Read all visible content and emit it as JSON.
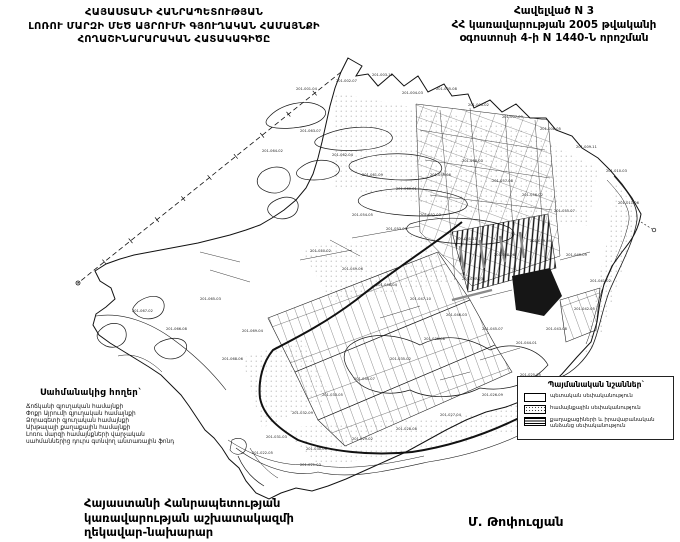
{
  "document": {
    "title_lines": [
      "ՀԱՅԱՍՏԱՆԻ ՀԱՆՐԱՊԵՏՈՒԹՅԱՆ",
      "ԼՈՌՈՒ ՄԱՐԶԻ ՄԵԾ ԱՅՐՈՒՄԻ ԳՅՈՒՂԱԿԱՆ ՀԱՄԱՅՆՔԻ",
      "ՀՈՂԱՇԻՆԱՐԱՐԱԿԱՆ ՀԱՏԱԿԱԳԻԾԸ"
    ],
    "annex_lines": [
      "Հավելված N 3",
      "ՀՀ կառավարության 2005 թվականի",
      "օգոստոսի 4-ի N 1440-Ն որոշման"
    ]
  },
  "adjacent_lands": {
    "title": "Սահմանակից հողեր`",
    "lines": [
      "Ճոճկանի գյուղական համայնքի",
      "Փոքր Այրումի գյուղական համայնքի",
      "Ձորագետի գյուղական համայնքի",
      "Ախթալայի քաղաքային համայնքի",
      "Լոռու մարզի համայնքների վարչական",
      "սահմաններից դուրս գտնվող անտառային ֆոնդ"
    ]
  },
  "legend": {
    "title": "Պայմանական նշաններ`",
    "items": [
      {
        "label": "պետական սեփականություն"
      },
      {
        "label": "համայնքային սեփականություն"
      },
      {
        "label": "քաղաքացիների և իրավաբանական անձանց սեփականություն"
      }
    ]
  },
  "footer": {
    "issuer_lines": [
      "Հայաստանի Հանրապետության",
      "կառավարության աշխատակազմի",
      "ղեկավար-նախարար"
    ],
    "signature": "Մ. Թոփուզյան"
  },
  "map": {
    "parcel_labels": [
      [
        "201-001-04",
        296,
        90
      ],
      [
        "201-002-07",
        336,
        82
      ],
      [
        "201-003-12",
        372,
        76
      ],
      [
        "201-004-03",
        402,
        94
      ],
      [
        "201-005-08",
        436,
        90
      ],
      [
        "201-006-02",
        468,
        106
      ],
      [
        "201-007-09",
        502,
        118
      ],
      [
        "201-008-05",
        540,
        130
      ],
      [
        "201-009-11",
        576,
        148
      ],
      [
        "201-010-03",
        606,
        172
      ],
      [
        "201-011-06",
        618,
        204
      ],
      [
        "201-064-02",
        262,
        152
      ],
      [
        "201-063-07",
        300,
        132
      ],
      [
        "201-062-04",
        332,
        156
      ],
      [
        "201-061-09",
        362,
        176
      ],
      [
        "201-060-01",
        396,
        190
      ],
      [
        "201-059-06",
        430,
        176
      ],
      [
        "201-058-03",
        462,
        162
      ],
      [
        "201-057-08",
        492,
        182
      ],
      [
        "201-056-02",
        522,
        196
      ],
      [
        "201-055-07",
        554,
        212
      ],
      [
        "201-054-05",
        352,
        216
      ],
      [
        "201-053-09",
        386,
        230
      ],
      [
        "201-052-03",
        420,
        216
      ],
      [
        "201-051-11",
        456,
        240
      ],
      [
        "201-050-02",
        310,
        252
      ],
      [
        "201-049-06",
        342,
        270
      ],
      [
        "201-048-04",
        376,
        286
      ],
      [
        "201-047-10",
        410,
        300
      ],
      [
        "201-046-03",
        446,
        316
      ],
      [
        "201-045-07",
        482,
        330
      ],
      [
        "201-044-01",
        516,
        344
      ],
      [
        "201-043-08",
        546,
        330
      ],
      [
        "201-042-05",
        574,
        310
      ],
      [
        "201-041-02",
        590,
        282
      ],
      [
        "201-040-09",
        566,
        256
      ],
      [
        "201-039-04",
        530,
        242
      ],
      [
        "201-038-06",
        494,
        256
      ],
      [
        "201-037-03",
        462,
        280
      ],
      [
        "201-036-08",
        424,
        340
      ],
      [
        "201-035-02",
        390,
        360
      ],
      [
        "201-034-07",
        354,
        380
      ],
      [
        "201-033-05",
        322,
        396
      ],
      [
        "201-032-09",
        292,
        414
      ],
      [
        "201-031-03",
        266,
        438
      ],
      [
        "201-030-06",
        306,
        450
      ],
      [
        "201-029-02",
        352,
        440
      ],
      [
        "201-028-08",
        396,
        430
      ],
      [
        "201-027-04",
        440,
        416
      ],
      [
        "201-026-09",
        482,
        396
      ],
      [
        "201-025-05",
        520,
        376
      ],
      [
        "201-065-03",
        200,
        300
      ],
      [
        "201-066-08",
        166,
        330
      ],
      [
        "201-067-02",
        132,
        312
      ],
      [
        "201-068-06",
        222,
        360
      ],
      [
        "201-069-04",
        242,
        332
      ],
      [
        "201-021-03",
        300,
        466
      ],
      [
        "201-022-05",
        252,
        454
      ]
    ]
  }
}
